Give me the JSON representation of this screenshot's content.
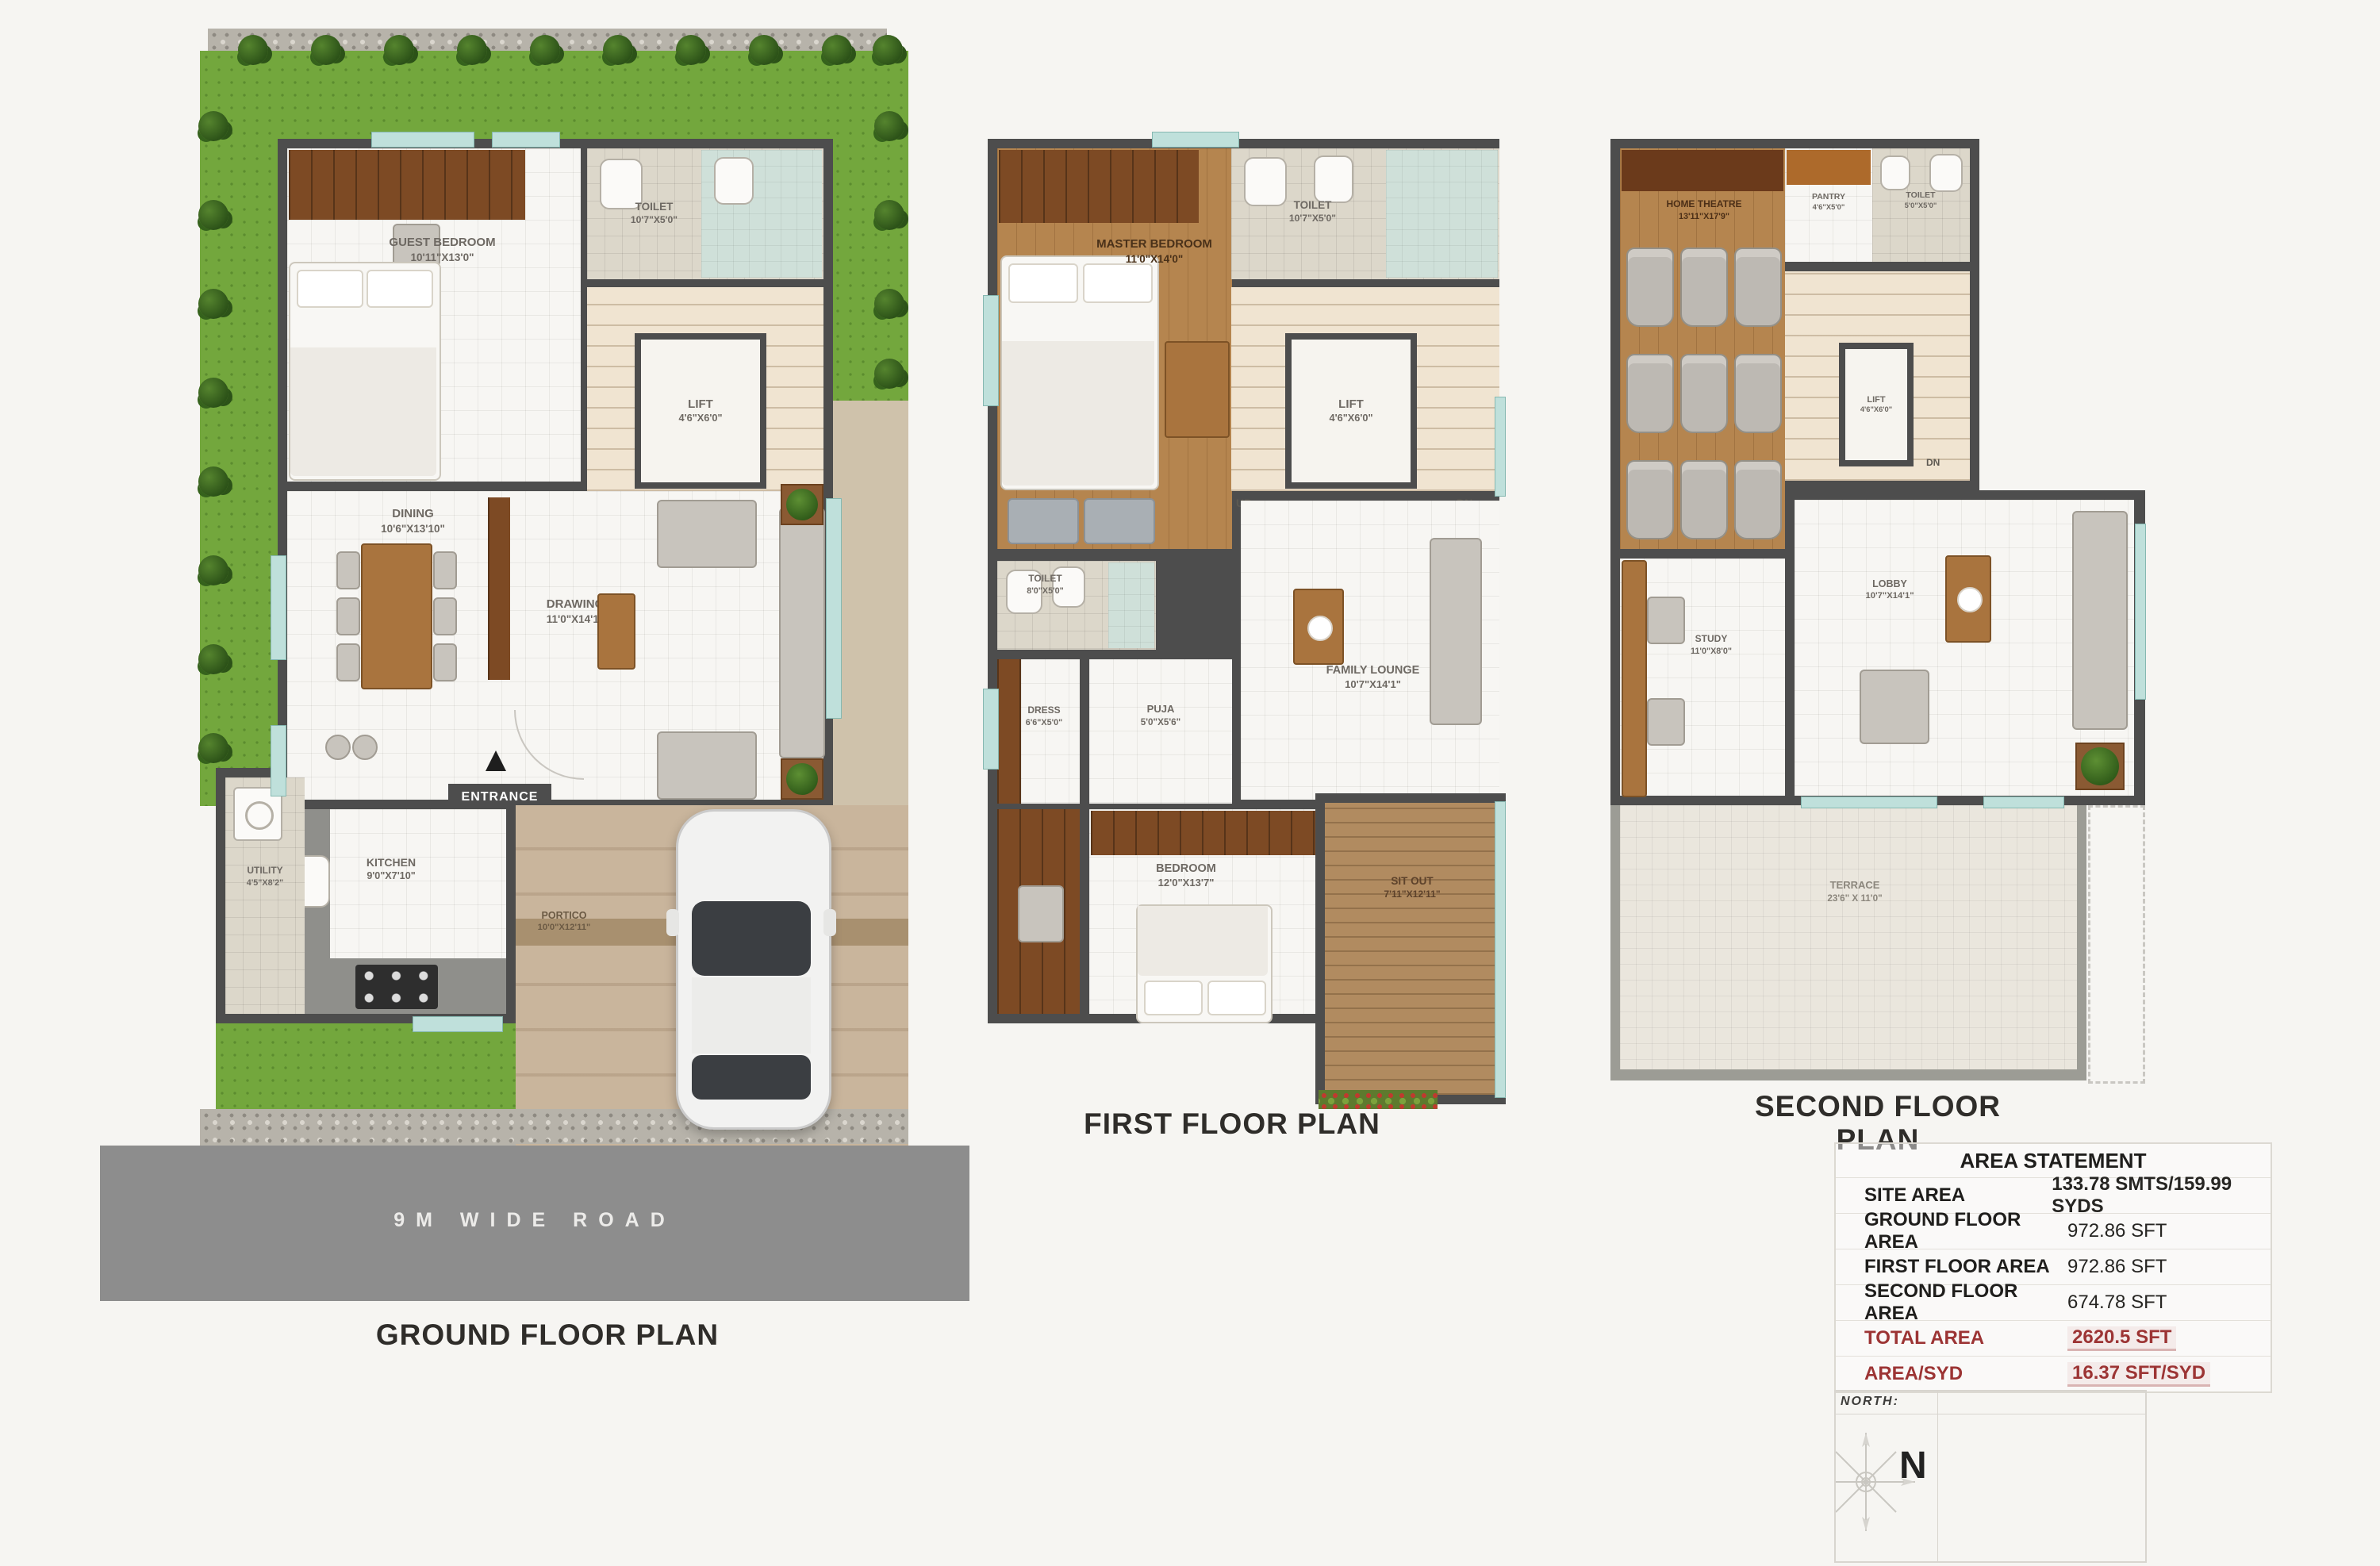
{
  "ground": {
    "title": "GROUND FLOOR PLAN",
    "road": "9M WIDE ROAD",
    "entrance": "ENTRANCE",
    "up": "UP",
    "rooms": {
      "guest_bedroom": {
        "name": "GUEST BEDROOM",
        "dims": "10'11\"X13'0\""
      },
      "toilet": {
        "name": "TOILET",
        "dims": "10'7\"X5'0\""
      },
      "lift": {
        "name": "LIFT",
        "dims": "4'6\"X6'0\""
      },
      "dining": {
        "name": "DINING",
        "dims": "10'6\"X13'10\""
      },
      "drawing": {
        "name": "DRAWING",
        "dims": "11'0\"X14'1\""
      },
      "kitchen": {
        "name": "KITCHEN",
        "dims": "9'0\"X7'10\""
      },
      "utility": {
        "name": "UTILITY",
        "dims": "4'5\"X8'2\""
      },
      "portico": {
        "name": "PORTICO",
        "dims": "10'0\"X12'11\""
      }
    }
  },
  "first": {
    "title": "FIRST FLOOR PLAN",
    "up": "UP",
    "dn": "DN",
    "rooms": {
      "master_bedroom": {
        "name": "MASTER BEDROOM",
        "dims": "11'0\"X14'0\""
      },
      "toilet_top": {
        "name": "TOILET",
        "dims": "10'7\"X5'0\""
      },
      "lift": {
        "name": "LIFT",
        "dims": "4'6\"X6'0\""
      },
      "toilet_mid": {
        "name": "TOILET",
        "dims": "8'0\"X5'0\""
      },
      "dress": {
        "name": "DRESS",
        "dims": "6'6\"X5'0\""
      },
      "puja": {
        "name": "PUJA",
        "dims": "5'0\"X5'6\""
      },
      "family_lounge": {
        "name": "FAMILY LOUNGE",
        "dims": "10'7\"X14'1\""
      },
      "bedroom": {
        "name": "BEDROOM",
        "dims": "12'0\"X13'7\""
      },
      "sit_out": {
        "name": "SIT OUT",
        "dims": "7'11\"X12'11\""
      }
    }
  },
  "second": {
    "title": "SECOND FLOOR PLAN",
    "dn": "DN",
    "rooms": {
      "home_theatre": {
        "name": "HOME THEATRE",
        "dims": "13'11\"X17'9\""
      },
      "pantry": {
        "name": "PANTRY",
        "dims": "4'6\"X5'0\""
      },
      "toilet": {
        "name": "TOILET",
        "dims": "5'0\"X5'0\""
      },
      "lift": {
        "name": "LIFT",
        "dims": "4'6\"X6'0\""
      },
      "study": {
        "name": "STUDY",
        "dims": "11'0\"X8'0\""
      },
      "lobby": {
        "name": "LOBBY",
        "dims": "10'7\"X14'1\""
      },
      "terrace": {
        "name": "TERRACE",
        "dims": "23'6\" X 11'0\""
      }
    }
  },
  "area_statement": {
    "title": "AREA STATEMENT",
    "rows": [
      {
        "label": "SITE AREA",
        "value": "133.78 SMTS/159.99 SYDS"
      },
      {
        "label": "GROUND FLOOR AREA",
        "value": "972.86 SFT"
      },
      {
        "label": "FIRST FLOOR AREA",
        "value": "972.86 SFT"
      },
      {
        "label": "SECOND FLOOR AREA",
        "value": "674.78 SFT"
      },
      {
        "label": "TOTAL AREA",
        "value": "2620.5 SFT"
      },
      {
        "label": "AREA/SYD",
        "value": "16.37 SFT/SYD"
      }
    ]
  },
  "compass": {
    "label": "NORTH:",
    "n": "N"
  },
  "colors": {
    "wall": "#4d4d4d",
    "grass": "#73a73d",
    "road": "#8d8d8d",
    "accent_red": "#9c3434",
    "wood": "#b5854f",
    "window": "#bfe0db"
  }
}
